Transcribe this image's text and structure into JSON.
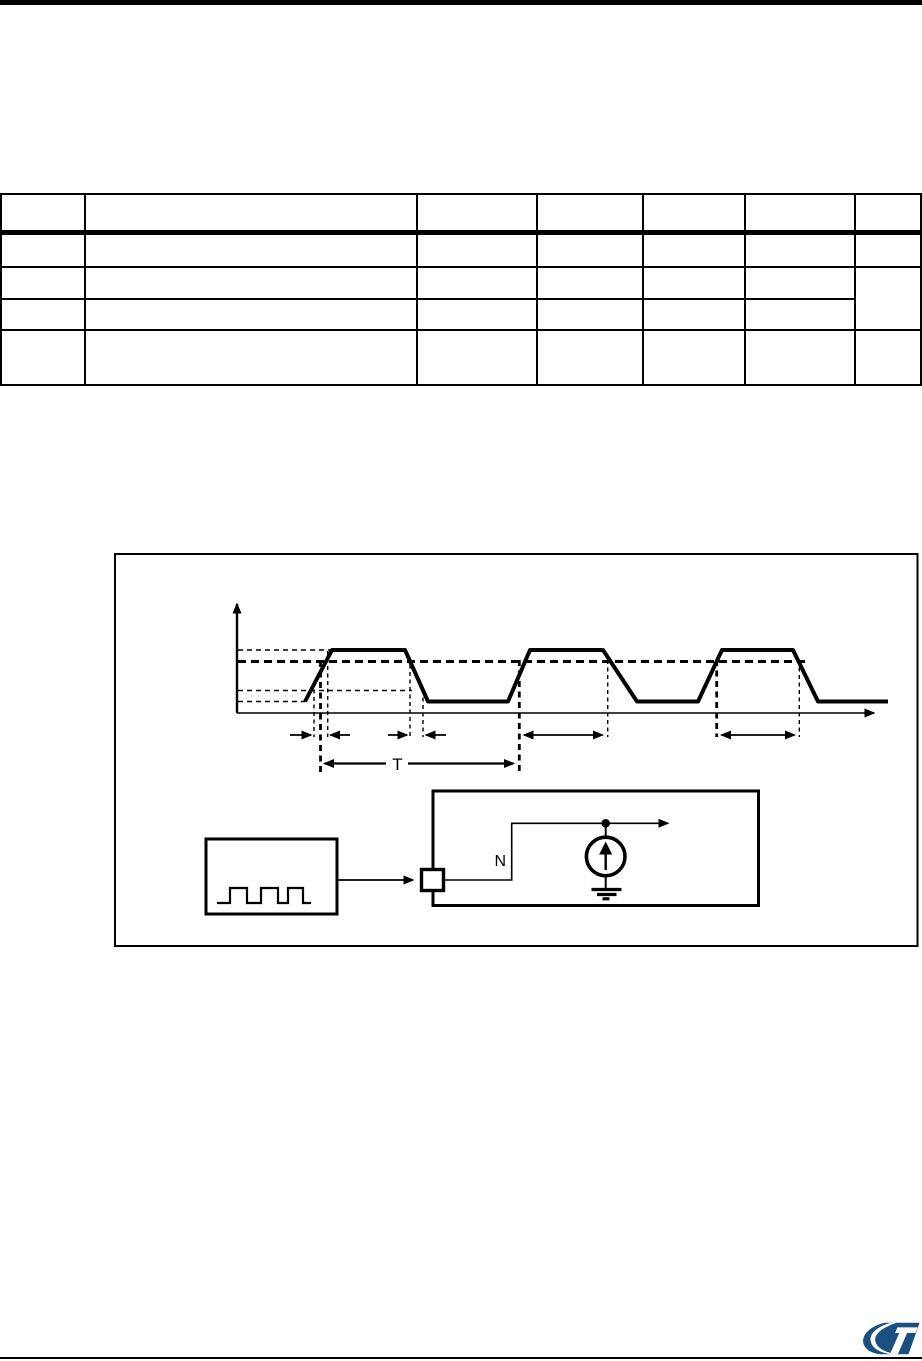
{
  "page": {
    "background": "#ffffff",
    "rule_color": "#000000"
  },
  "table": {
    "header": [
      "",
      "",
      "",
      "",
      "",
      "",
      ""
    ],
    "rows": [
      [
        "",
        "",
        "",
        "",
        "",
        "",
        ""
      ],
      [
        "",
        "",
        "",
        "",
        "",
        "",
        ""
      ],
      [
        "",
        "",
        "",
        "",
        "",
        ""
      ],
      [
        "",
        "",
        "",
        "",
        "",
        "",
        ""
      ]
    ]
  },
  "figure": {
    "period_label": "T",
    "node_label": "N"
  },
  "logo": {
    "title": "ST",
    "color": "#1b4f7f"
  }
}
